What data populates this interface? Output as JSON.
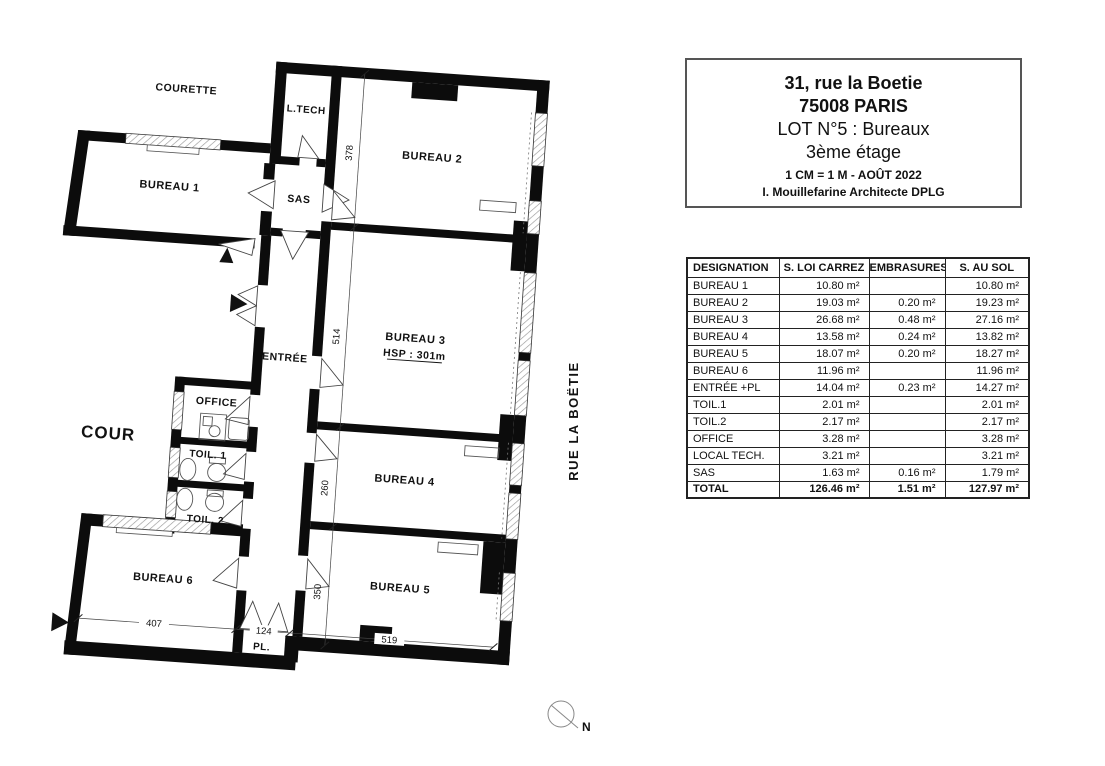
{
  "title_block": {
    "line1": "31, rue la Boetie",
    "line2": "75008 PARIS",
    "line3": "LOT N°5 : Bureaux",
    "line4": "3ème étage",
    "line5": "1 CM = 1 M - AOÛT 2022",
    "line6": "I. Mouillefarine Architecte DPLG"
  },
  "table": {
    "headers": [
      "DESIGNATION",
      "S. LOI CARREZ",
      "EMBRASURES",
      "S. AU SOL"
    ],
    "rows": [
      {
        "designation": "BUREAU 1",
        "carrez": "10.80 m²",
        "embrasures": "",
        "sol": "10.80 m²"
      },
      {
        "designation": "BUREAU 2",
        "carrez": "19.03 m²",
        "embrasures": "0.20 m²",
        "sol": "19.23 m²"
      },
      {
        "designation": "BUREAU 3",
        "carrez": "26.68 m²",
        "embrasures": "0.48 m²",
        "sol": "27.16 m²"
      },
      {
        "designation": "BUREAU 4",
        "carrez": "13.58 m²",
        "embrasures": "0.24 m²",
        "sol": "13.82 m²"
      },
      {
        "designation": "BUREAU 5",
        "carrez": "18.07 m²",
        "embrasures": "0.20 m²",
        "sol": "18.27 m²"
      },
      {
        "designation": "BUREAU 6",
        "carrez": "11.96 m²",
        "embrasures": "",
        "sol": "11.96 m²"
      },
      {
        "designation": "ENTRÉE +PL",
        "carrez": "14.04 m²",
        "embrasures": "0.23 m²",
        "sol": "14.27 m²"
      },
      {
        "designation": "TOIL.1",
        "carrez": "2.01 m²",
        "embrasures": "",
        "sol": "2.01 m²"
      },
      {
        "designation": "TOIL.2",
        "carrez": "2.17 m²",
        "embrasures": "",
        "sol": "2.17 m²"
      },
      {
        "designation": "OFFICE",
        "carrez": "3.28 m²",
        "embrasures": "",
        "sol": "3.28 m²"
      },
      {
        "designation": "LOCAL TECH.",
        "carrez": "3.21 m²",
        "embrasures": "",
        "sol": "3.21 m²"
      },
      {
        "designation": "SAS",
        "carrez": "1.63 m²",
        "embrasures": "0.16 m²",
        "sol": "1.79 m²"
      },
      {
        "designation": "TOTAL",
        "carrez": "126.46 m²",
        "embrasures": "1.51 m²",
        "sol": "127.97 m²"
      }
    ]
  },
  "plan": {
    "labels": {
      "courette": "COURETTE",
      "ltech": "L.TECH",
      "sas": "SAS",
      "bureau1": "BUREAU 1",
      "bureau2": "BUREAU 2",
      "bureau3": "BUREAU 3",
      "hsp": "HSP : 301m",
      "entree": "ENTRÉE",
      "office": "OFFICE",
      "cour": "COUR",
      "toil1": "TOIL. 1",
      "toil2": "TOIL. 2",
      "bureau4": "BUREAU 4",
      "bureau5": "BUREAU 5",
      "bureau6": "BUREAU 6",
      "pl": "PL.",
      "street": "RUE LA BOËTIE",
      "north": "N"
    },
    "dimensions": {
      "d378": "378",
      "d514": "514",
      "d260": "260",
      "d350": "350",
      "d407": "407",
      "d124": "124",
      "d519": "519"
    }
  }
}
